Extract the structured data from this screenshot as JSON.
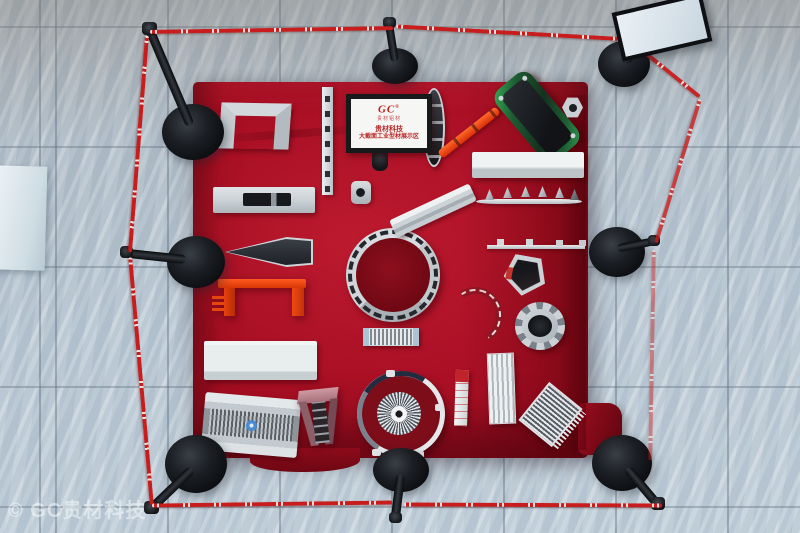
{
  "scene": {
    "type": "photograph-top-down",
    "subject": "aluminium extrusion profiles displayed on a red velvet platform, cordoned off by black stanchions with red barrier tape, on gray marble tile floor",
    "stanchion_count": 8
  },
  "signboard": {
    "logo": "GC",
    "logo_mark": "®",
    "logo_caption": "贵材铝材",
    "title": "贵材科技",
    "subtitle": "大截面工业型材展示区"
  },
  "watermark": {
    "text": "© GC贵材科技"
  },
  "colors": {
    "carpet_red": "#a60e22",
    "tape_red": "#c91d1d",
    "stanchion_black": "#17191c",
    "floor_marble": "#bccad5",
    "profile_silver": "#d4dade",
    "accent_orange": "#e8420e",
    "anodized_green": "#2f9e4f",
    "sign_text_red": "#b82828"
  },
  "objects": [
    "u-channel-profile",
    "slotted-strip-profile",
    "round-connector-profile",
    "slot-bar-profile",
    "wing-profile",
    "red-bench-profile",
    "panel-box-profile",
    "ribbed-panel-profile",
    "corner-bracket-profile",
    "large-ring-profile",
    "skirting-diagonal-profile",
    "boat-profile",
    "red-bar-profile",
    "green-tube-profile",
    "hex-nut-profile",
    "rect-box-profile",
    "serrated-rail-profile",
    "tab-rail-profile",
    "pentagon-profile",
    "gear-ring-profile",
    "curved-arc-profile",
    "heatsink-strip-profile",
    "round-heatsink-profile",
    "label-strip-profile",
    "striped-box-profile",
    "heatsink-plate-profile"
  ]
}
